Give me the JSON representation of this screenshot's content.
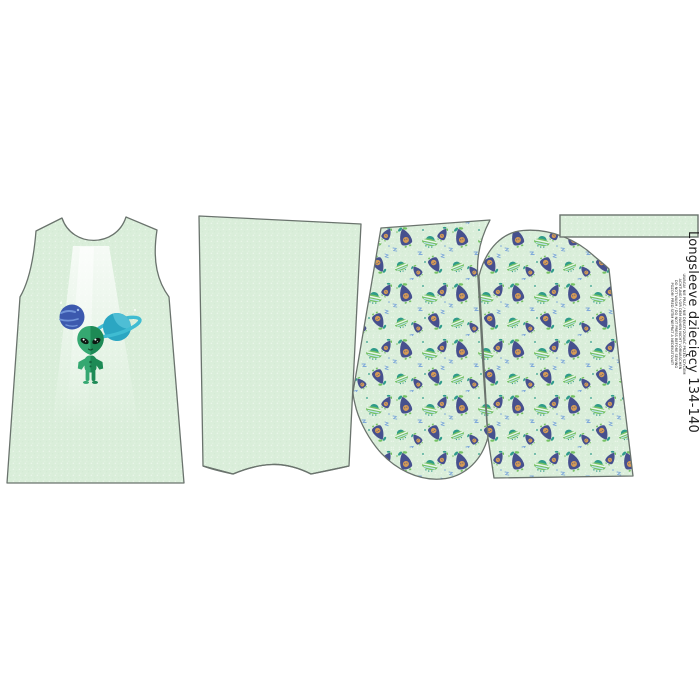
{
  "panel": {
    "label": {
      "title": "Longsleeve dziecięcy 134-140",
      "care_lines": [
        "UWAGA! NIE PRAĆ / NIE DEKATYZOWAĆ PRZED SZYCIEM",
        "ACHTUNG! VOR DEM NÄHEN NICHT VORWASCHEN",
        "DO NOT WASH / DO NOT PRESS BEFORE SEWING",
        "POZOR! PŘED ŠITÍM NEPRAT A NEDEKATOVAT!"
      ]
    },
    "pieces": [
      {
        "name": "front-bodice",
        "print": "alien-with-planets-placement-graphic"
      },
      {
        "name": "back-bodice",
        "print": "plain-mint"
      },
      {
        "name": "sleeve-left",
        "print": "alien-ufo-allover-pattern"
      },
      {
        "name": "sleeve-right",
        "print": "alien-ufo-allover-pattern"
      },
      {
        "name": "neckband-strip",
        "print": "plain-mint"
      }
    ],
    "front_graphic_elements": [
      "blue-planet",
      "saturn-planet",
      "alien",
      "light-beam"
    ]
  },
  "colors": {
    "page_bg": "#ffffff",
    "fabric_mint": "#daeeda",
    "fabric_speck": "#eef8ee",
    "outline": "#6a736d",
    "alien_green": "#35a871",
    "alien_green_dark": "#1d8a55",
    "alien_eye": "#0c1a12",
    "planet_blue": "#3c59ae",
    "planet_blue_light": "#7093d8",
    "saturn_teal": "#2ba6c2",
    "saturn_teal_light": "#55c2d8",
    "saturn_ring": "#3fbcd2",
    "motif_navy": "#46508e",
    "motif_face": "#d49a55",
    "motif_teal": "#2f9b8a",
    "motif_green": "#74c163",
    "motif_blue": "#7fa9da",
    "text_color": "#1f1f1f"
  }
}
